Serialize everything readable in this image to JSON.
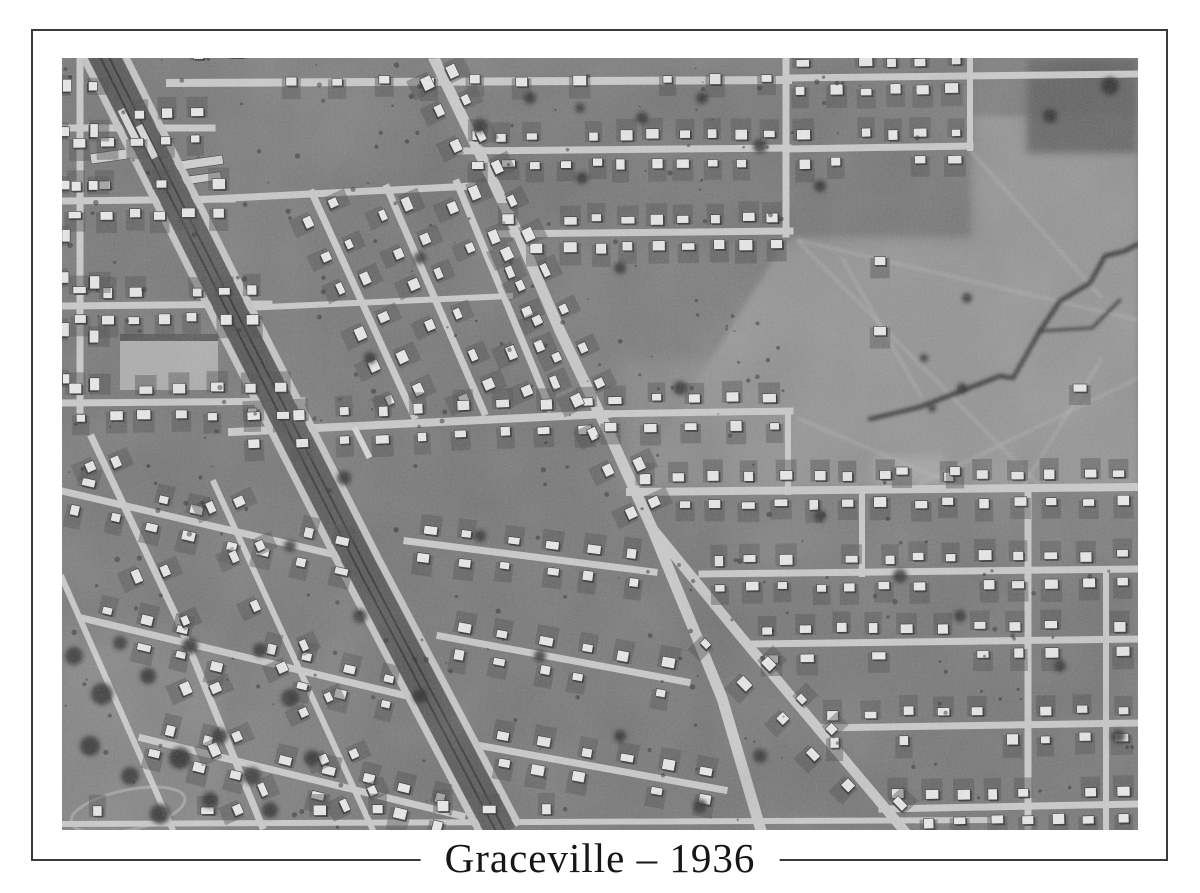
{
  "page": {
    "background": "#ffffff",
    "frame_color": "#3a3a3a"
  },
  "caption": {
    "text": "Graceville – 1936"
  },
  "photo": {
    "description": "Black-and-white 1936 aerial photograph of the Graceville suburb: a diagonal railway corridor and a diagonal main road cross tilted residential street grids of small house lots; open paddocks with a dark creek gully on the right; tree clusters in the lower left.",
    "seed": 7,
    "palette": {
      "base": "#7b7b7b",
      "field": "#939393",
      "road": "#cbcbcb",
      "rail_band": "#565656",
      "rail_track": "#343434",
      "rail_side_road": "#c6c6c6",
      "house": "#ebebeb",
      "house_stroke": "#2b2b2b",
      "house_shadow": "#2b2b2b",
      "yard": "#4c4c4c",
      "tree": "#2c2c2c",
      "trail": "#bcbcbc",
      "creek": "#2e2e2e",
      "platform": "#dadada",
      "shed": "#d2d2d2",
      "court": "#b3b3b3",
      "court_strip": "#3f3f3f",
      "oval_line": "#a9a9a9"
    },
    "railway": {
      "pts": [
        [
          38,
          -10
        ],
        [
          168,
          250
        ],
        [
          300,
          510
        ],
        [
          440,
          776
        ]
      ],
      "band_width": 30,
      "side_offset": 19,
      "side_width": 7,
      "track_offset": 4
    },
    "platforms": [
      [
        62,
        50,
        36,
        7
      ],
      [
        80,
        66,
        36,
        7
      ],
      [
        295,
        368,
        34,
        6
      ]
    ],
    "sheds": [
      [
        97,
        106,
        64,
        9
      ],
      [
        99,
        122,
        60,
        8
      ],
      [
        28,
        96,
        42,
        10
      ]
    ],
    "roads": [
      {
        "pts": [
          [
            368,
            -8
          ],
          [
            420,
            100
          ],
          [
            458,
            180
          ],
          [
            498,
            273
          ],
          [
            546,
            373
          ],
          [
            590,
            470
          ],
          [
            660,
            640
          ],
          [
            700,
            776
          ]
        ],
        "w": 11
      },
      {
        "pts": [
          [
            590,
            470
          ],
          [
            680,
            580
          ],
          [
            845,
            776
          ]
        ],
        "w": 10
      },
      {
        "pts": [
          [
            18,
            -8
          ],
          [
            18,
            352
          ]
        ],
        "w": 7
      },
      {
        "pts": [
          [
            0,
            70
          ],
          [
            150,
            70
          ]
        ],
        "w": 7
      },
      {
        "pts": [
          [
            0,
            143
          ],
          [
            170,
            141
          ]
        ],
        "w": 7
      },
      {
        "pts": [
          [
            0,
            248
          ],
          [
            207,
            246
          ]
        ],
        "w": 7
      },
      {
        "pts": [
          [
            0,
            345
          ],
          [
            240,
            343
          ]
        ],
        "w": 7
      },
      {
        "pts": [
          [
            108,
            25
          ],
          [
            726,
            22
          ]
        ],
        "w": 8
      },
      {
        "pts": [
          [
            398,
            93
          ],
          [
            726,
            90
          ]
        ],
        "w": 7
      },
      {
        "pts": [
          [
            432,
            176
          ],
          [
            728,
            173
          ]
        ],
        "w": 7
      },
      {
        "pts": [
          [
            532,
            356
          ],
          [
            728,
            353
          ]
        ],
        "w": 7
      },
      {
        "pts": [
          [
            568,
            434
          ],
          [
            1076,
            429
          ]
        ],
        "w": 8
      },
      {
        "pts": [
          [
            724,
            -8
          ],
          [
            724,
            176
          ]
        ],
        "w": 7
      },
      {
        "pts": [
          [
            726,
            356
          ],
          [
            726,
            434
          ]
        ],
        "w": 6
      },
      {
        "pts": [
          [
            726,
            20
          ],
          [
            1076,
            16
          ]
        ],
        "w": 7
      },
      {
        "pts": [
          [
            726,
            91
          ],
          [
            908,
            88
          ]
        ],
        "w": 7
      },
      {
        "pts": [
          [
            908,
            -8
          ],
          [
            908,
            90
          ]
        ],
        "w": 6
      },
      {
        "pts": [
          [
            640,
            516
          ],
          [
            1076,
            511
          ]
        ],
        "w": 7
      },
      {
        "pts": [
          [
            692,
            586
          ],
          [
            1076,
            581
          ]
        ],
        "w": 7
      },
      {
        "pts": [
          [
            756,
            670
          ],
          [
            1076,
            665
          ]
        ],
        "w": 7
      },
      {
        "pts": [
          [
            820,
            751
          ],
          [
            1076,
            746
          ]
        ],
        "w": 7
      },
      {
        "pts": [
          [
            966,
            434
          ],
          [
            966,
            772
          ]
        ],
        "w": 7
      },
      {
        "pts": [
          [
            1044,
            516
          ],
          [
            1044,
            772
          ]
        ],
        "w": 6
      },
      {
        "pts": [
          [
            800,
            434
          ],
          [
            800,
            516
          ]
        ],
        "w": 6
      },
      {
        "pts": [
          [
            250,
            135
          ],
          [
            352,
            358
          ]
        ],
        "w": 7
      },
      {
        "pts": [
          [
            325,
            130
          ],
          [
            422,
            354
          ]
        ],
        "w": 7
      },
      {
        "pts": [
          [
            395,
            125
          ],
          [
            488,
            350
          ]
        ],
        "w": 7
      },
      {
        "pts": [
          [
            128,
            142
          ],
          [
            410,
            128
          ]
        ],
        "w": 7
      },
      {
        "pts": [
          [
            182,
            250
          ],
          [
            448,
            238
          ]
        ],
        "w": 6
      },
      {
        "pts": [
          [
            170,
            374
          ],
          [
            545,
            356
          ]
        ],
        "w": 8
      },
      {
        "pts": [
          [
            0,
            433
          ],
          [
            300,
            503
          ]
        ],
        "w": 7
      },
      {
        "pts": [
          [
            20,
            560
          ],
          [
            345,
            638
          ]
        ],
        "w": 7
      },
      {
        "pts": [
          [
            80,
            680
          ],
          [
            400,
            758
          ]
        ],
        "w": 7
      },
      {
        "pts": [
          [
            30,
            380
          ],
          [
            115,
            560
          ],
          [
            200,
            768
          ]
        ],
        "w": 7
      },
      {
        "pts": [
          [
            0,
            520
          ],
          [
            110,
            770
          ]
        ],
        "w": 6
      },
      {
        "pts": [
          [
            152,
            425
          ],
          [
            310,
            770
          ]
        ],
        "w": 6
      },
      {
        "pts": [
          [
            345,
            483
          ],
          [
            592,
            514
          ]
        ],
        "w": 7
      },
      {
        "pts": [
          [
            378,
            578
          ],
          [
            625,
            624
          ]
        ],
        "w": 7
      },
      {
        "pts": [
          [
            420,
            688
          ],
          [
            662,
            732
          ]
        ],
        "w": 7
      },
      {
        "pts": [
          [
            0,
            766
          ],
          [
            940,
            762
          ]
        ],
        "w": 6
      }
    ],
    "patches": [
      {
        "poly": [
          [
            726,
            178
          ],
          [
            908,
            178
          ],
          [
            908,
            58
          ],
          [
            1076,
            58
          ],
          [
            1076,
            430
          ],
          [
            568,
            430
          ]
        ],
        "fill": "#939393",
        "op": 1,
        "blur": 3
      },
      {
        "rect": [
          965,
          0,
          111,
          95
        ],
        "fill": "#5e5e5e",
        "op": 0.9,
        "blur": 4
      },
      {
        "rect": [
          -5,
          555,
          165,
          220
        ],
        "fill": "#848484",
        "op": 0.8,
        "blur": 6
      },
      {
        "rect": [
          -5,
          -5,
          160,
          370
        ],
        "fill": "#747474",
        "op": 0.55,
        "blur": 8
      },
      {
        "rect": [
          360,
          20,
          370,
          165
        ],
        "fill": "#6f6f6f",
        "op": 0.5,
        "blur": 8
      },
      {
        "rect": [
          240,
          115,
          255,
          255
        ],
        "fill": "#717171",
        "op": 0.5,
        "blur": 8
      },
      {
        "rect": [
          300,
          360,
          360,
          415
        ],
        "fill": "#6f6f6f",
        "op": 0.45,
        "blur": 10
      },
      {
        "rect": [
          630,
          500,
          446,
          275
        ],
        "fill": "#717171",
        "op": 0.45,
        "blur": 10
      },
      {
        "rect": [
          726,
          0,
          185,
          180
        ],
        "fill": "#707070",
        "op": 0.5,
        "blur": 8
      },
      {
        "rect": [
          0,
          380,
          310,
          200
        ],
        "fill": "#757575",
        "op": 0.5,
        "blur": 10
      },
      {
        "rect": [
          560,
          300,
          170,
          130
        ],
        "fill": "#8e8e8e",
        "op": 0.6,
        "blur": 8
      },
      {
        "rect": [
          812,
          398,
          70,
          28
        ],
        "fill": "#b7b7b7",
        "op": 0.5,
        "blur": 5
      }
    ],
    "trails": [
      [
        [
          735,
          182
        ],
        [
          1076,
          262
        ]
      ],
      [
        [
          735,
          182
        ],
        [
          980,
          430
        ]
      ],
      [
        [
          908,
          92
        ],
        [
          1040,
          240
        ]
      ],
      [
        [
          850,
          430
        ],
        [
          1076,
          320
        ]
      ],
      [
        [
          735,
          360
        ],
        [
          900,
          430
        ]
      ],
      [
        [
          780,
          200
        ],
        [
          860,
          340
        ]
      ],
      [
        [
          960,
          430
        ],
        [
          1040,
          300
        ]
      ]
    ],
    "creek": {
      "main": [
        [
          808,
          361
        ],
        [
          858,
          349
        ],
        [
          938,
          318
        ],
        [
          951,
          320
        ],
        [
          978,
          273
        ],
        [
          998,
          243
        ],
        [
          1028,
          225
        ],
        [
          1043,
          198
        ],
        [
          1063,
          193
        ],
        [
          1076,
          186
        ]
      ],
      "branch": [
        [
          978,
          273
        ],
        [
          1030,
          270
        ],
        [
          1058,
          242
        ]
      ]
    },
    "court": {
      "rect": [
        58,
        276,
        98,
        56
      ]
    },
    "oval": {
      "cx": 66,
      "cy": 752,
      "rx": 58,
      "ry": 20,
      "rot": -12
    },
    "house_rows": [
      [
        108,
        10,
        726,
        7,
        13,
        2
      ],
      [
        0,
        70,
        148,
        68,
        5,
        2
      ],
      [
        0,
        143,
        168,
        141,
        6,
        2
      ],
      [
        0,
        248,
        205,
        246,
        7,
        2
      ],
      [
        0,
        345,
        238,
        343,
        7,
        2
      ],
      [
        18,
        0,
        18,
        350,
        7,
        2
      ],
      [
        398,
        93,
        726,
        90,
        11,
        2
      ],
      [
        432,
        176,
        728,
        173,
        10,
        2
      ],
      [
        726,
        20,
        906,
        17,
        6,
        2
      ],
      [
        726,
        91,
        906,
        88,
        6,
        2
      ],
      [
        250,
        135,
        352,
        358,
        6,
        2
      ],
      [
        325,
        130,
        422,
        354,
        6,
        2
      ],
      [
        395,
        125,
        488,
        350,
        6,
        2
      ],
      [
        175,
        373,
        545,
        356,
        9,
        2
      ],
      [
        532,
        356,
        728,
        353,
        5,
        2
      ],
      [
        568,
        434,
        1076,
        429,
        15,
        2
      ],
      [
        640,
        516,
        1076,
        511,
        13,
        2
      ],
      [
        692,
        586,
        1076,
        581,
        11,
        2
      ],
      [
        756,
        670,
        1076,
        665,
        9,
        2
      ],
      [
        820,
        751,
        1076,
        746,
        8,
        2
      ],
      [
        0,
        433,
        300,
        503,
        8,
        2
      ],
      [
        20,
        560,
        345,
        638,
        8,
        2
      ],
      [
        80,
        680,
        400,
        758,
        8,
        2
      ],
      [
        30,
        380,
        200,
        768,
        7,
        2
      ],
      [
        152,
        425,
        310,
        770,
        7,
        2
      ],
      [
        345,
        483,
        592,
        514,
        6,
        2
      ],
      [
        378,
        578,
        625,
        624,
        6,
        2
      ],
      [
        420,
        688,
        662,
        732,
        6,
        2
      ],
      [
        368,
        0,
        496,
        270,
        8,
        2
      ],
      [
        498,
        273,
        590,
        468,
        5,
        2
      ],
      [
        640,
        560,
        845,
        770,
        6,
        2
      ],
      [
        0,
        766,
        520,
        763,
        9,
        -1
      ]
    ],
    "single_lots": [
      [
        818,
        203
      ],
      [
        818,
        273
      ],
      [
        840,
        413
      ],
      [
        893,
        413
      ],
      [
        1018,
        330
      ]
    ],
    "trees": [
      [
        12,
        598,
        9
      ],
      [
        40,
        636,
        11
      ],
      [
        86,
        618,
        8
      ],
      [
        28,
        688,
        10
      ],
      [
        68,
        718,
        9
      ],
      [
        118,
        700,
        11
      ],
      [
        158,
        678,
        8
      ],
      [
        98,
        756,
        10
      ],
      [
        148,
        742,
        8
      ],
      [
        190,
        718,
        9
      ],
      [
        58,
        585,
        7
      ],
      [
        128,
        588,
        8
      ],
      [
        198,
        592,
        7
      ],
      [
        228,
        640,
        9
      ],
      [
        208,
        752,
        8
      ],
      [
        250,
        700,
        8
      ],
      [
        282,
        420,
        7
      ],
      [
        308,
        300,
        6
      ],
      [
        358,
        200,
        6
      ],
      [
        418,
        68,
        7
      ],
      [
        468,
        40,
        6
      ],
      [
        520,
        120,
        6
      ],
      [
        558,
        210,
        6
      ],
      [
        618,
        330,
        7
      ],
      [
        698,
        88,
        7
      ],
      [
        758,
        128,
        6
      ],
      [
        838,
        518,
        7
      ],
      [
        898,
        558,
        6
      ],
      [
        998,
        608,
        6
      ],
      [
        1056,
        678,
        7
      ],
      [
        758,
        458,
        6
      ],
      [
        698,
        698,
        7
      ],
      [
        638,
        748,
        7
      ],
      [
        558,
        678,
        6
      ],
      [
        478,
        598,
        6
      ],
      [
        1048,
        28,
        9
      ],
      [
        988,
        58,
        7
      ],
      [
        358,
        638,
        7
      ],
      [
        298,
        558,
        7
      ],
      [
        228,
        488,
        6
      ],
      [
        418,
        478,
        6
      ],
      [
        518,
        50,
        5
      ],
      [
        580,
        60,
        6
      ],
      [
        640,
        40,
        6
      ],
      [
        905,
        240,
        5
      ],
      [
        862,
        300,
        4
      ],
      [
        900,
        330,
        5
      ],
      [
        870,
        350,
        4
      ]
    ],
    "speckles": 320
  }
}
